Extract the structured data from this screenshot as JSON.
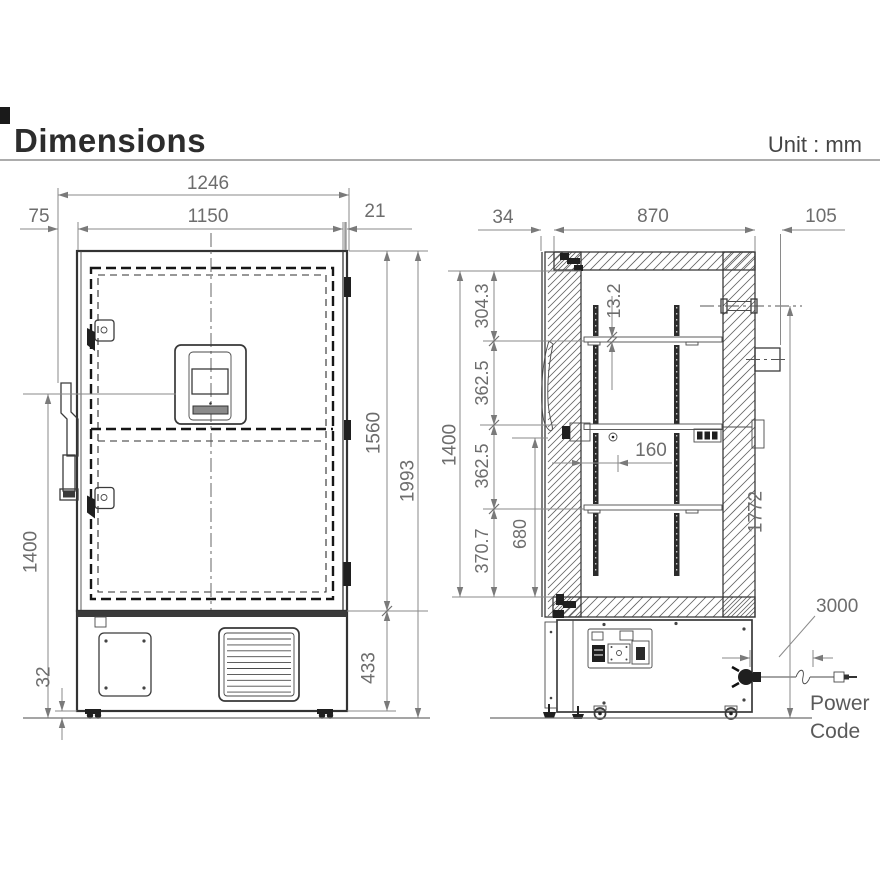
{
  "header": {
    "title": "Dimensions",
    "unit_label": "Unit : mm"
  },
  "front_view": {
    "dims": {
      "total_width": "1246",
      "body_width": "1150",
      "handle_depth": "75",
      "door_edge": "21",
      "door_height": "1560",
      "total_height": "1993",
      "base_height": "433",
      "handle_height": "1400",
      "foot_clearance": "32"
    }
  },
  "side_view": {
    "dims": {
      "door_thickness": "34",
      "body_depth": "870",
      "rear_clearance": "105",
      "top_offset": "304.3",
      "shelf_pitch_1": "362.5",
      "shelf_pitch_2": "362.5",
      "bottom_offset": "370.7",
      "interior_height": "1400",
      "shelf_thickness": "13.2",
      "shelf_inset": "160",
      "lower_height": "680",
      "port_height": "1772",
      "cord_length": "3000"
    },
    "power_cord": {
      "line1": "Power",
      "line2": "Code"
    }
  }
}
